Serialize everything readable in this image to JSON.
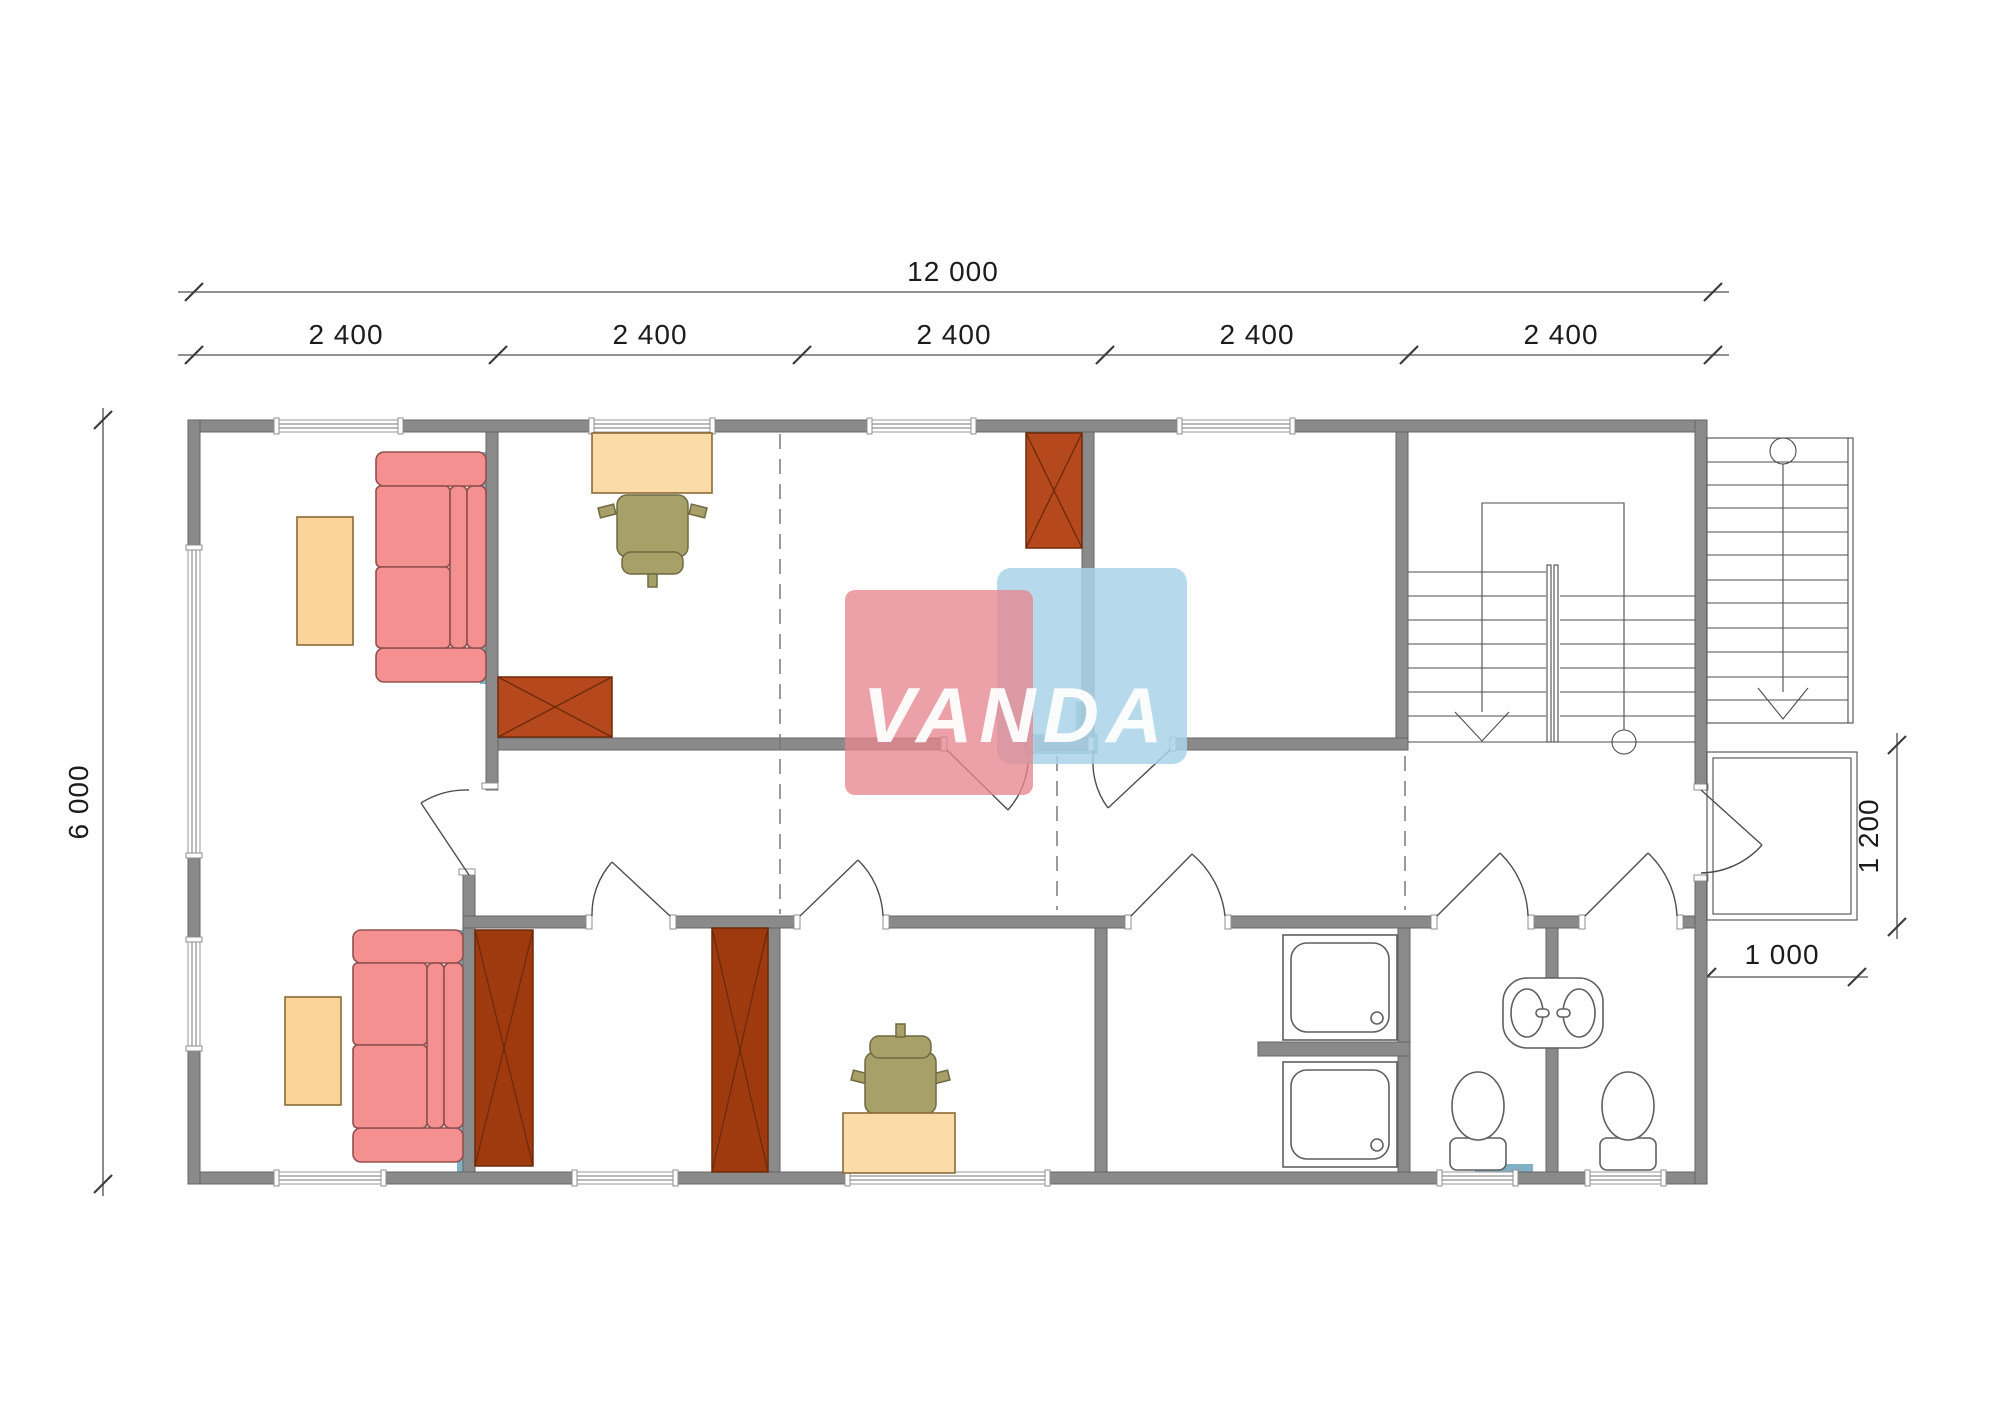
{
  "drawing": {
    "type": "floor-plan",
    "watermark_text": "VANDA",
    "dimensions": {
      "total_width": "12 000",
      "modules": [
        "2 400",
        "2 400",
        "2 400",
        "2 400",
        "2 400"
      ],
      "height": "6 000",
      "porch_depth": "1 200",
      "porch_width": "1 000"
    }
  },
  "furniture": [
    "sofa",
    "coffee-table",
    "desk",
    "office-chair",
    "wardrobe",
    "staircase",
    "exterior-stairs",
    "porch",
    "shower-tray",
    "toilet",
    "double-sink"
  ],
  "colors": {
    "wall": "#8a8a8a",
    "wall_stroke": "#656565",
    "line": "#4d4d4d",
    "sofa": "#f59090",
    "sofa_stroke": "#90504e",
    "table": "#fbd39b",
    "table_stroke": "#8a6a35",
    "desk": "#fbdca8",
    "chair": "#a8a069",
    "chair_stroke": "#6f6a42",
    "wardrobe": "#b5481c",
    "wardrobe_dark": "#9e3a0e",
    "wardrobe_stroke": "#6d2a0a",
    "accent": "#7fb0c4",
    "wm_pink": "#e5868e",
    "wm_blue": "#a9d3e8"
  }
}
